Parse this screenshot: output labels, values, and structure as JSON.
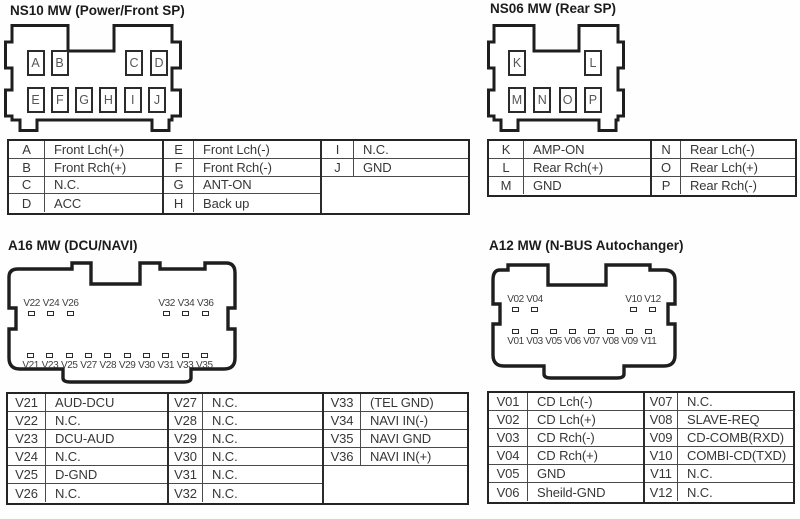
{
  "colors": {
    "ink": "#1e1e1e",
    "table_line": "#4a4a4a",
    "text": "#373737",
    "pin_text": "#555555",
    "background": "#ffffff"
  },
  "ns10": {
    "title": "NS10 MW (Power/Front SP)",
    "connector": {
      "top_left_pins": [
        "A",
        "B"
      ],
      "top_right_pins": [
        "C",
        "D"
      ],
      "bottom_pins": [
        "E",
        "F",
        "G",
        "H",
        "I",
        "J"
      ]
    },
    "table": {
      "group1": [
        {
          "p": "A",
          "d": "Front Lch(+)"
        },
        {
          "p": "B",
          "d": "Front Rch(+)"
        },
        {
          "p": "C",
          "d": "N.C."
        },
        {
          "p": "D",
          "d": "ACC"
        }
      ],
      "group2": [
        {
          "p": "E",
          "d": "Front Lch(-)"
        },
        {
          "p": "F",
          "d": "Front Rch(-)"
        },
        {
          "p": "G",
          "d": "ANT-ON"
        },
        {
          "p": "H",
          "d": "Back up"
        }
      ],
      "group3": [
        {
          "p": "I",
          "d": "N.C."
        },
        {
          "p": "J",
          "d": "GND"
        }
      ]
    }
  },
  "ns06": {
    "title": "NS06 MW (Rear SP)",
    "connector": {
      "top_left_pins": [
        "K"
      ],
      "top_right_pins": [
        "L"
      ],
      "bottom_pins": [
        "M",
        "N",
        "O",
        "P"
      ]
    },
    "table": {
      "group1": [
        {
          "p": "K",
          "d": "AMP-ON"
        },
        {
          "p": "L",
          "d": "Rear Rch(+)"
        },
        {
          "p": "M",
          "d": "GND"
        }
      ],
      "group2": [
        {
          "p": "N",
          "d": "Rear Lch(-)"
        },
        {
          "p": "O",
          "d": "Rear Lch(+)"
        },
        {
          "p": "P",
          "d": "Rear Rch(-)"
        }
      ]
    }
  },
  "a16": {
    "title": "A16 MW (DCU/NAVI)",
    "connector": {
      "top_left_pins": [
        "V22",
        "V24",
        "V26"
      ],
      "top_right_pins": [
        "V32",
        "V34",
        "V36"
      ],
      "bottom_pins": [
        "V21",
        "V23",
        "V25",
        "V27",
        "V28",
        "V29",
        "V30",
        "V31",
        "V33",
        "V35"
      ]
    },
    "table": {
      "group1": [
        {
          "p": "V21",
          "d": "AUD-DCU"
        },
        {
          "p": "V22",
          "d": "N.C."
        },
        {
          "p": "V23",
          "d": "DCU-AUD"
        },
        {
          "p": "V24",
          "d": "N.C."
        },
        {
          "p": "V25",
          "d": "D-GND"
        },
        {
          "p": "V26",
          "d": "N.C."
        }
      ],
      "group2": [
        {
          "p": "V27",
          "d": "N.C."
        },
        {
          "p": "V28",
          "d": "N.C."
        },
        {
          "p": "V29",
          "d": "N.C."
        },
        {
          "p": "V30",
          "d": "N.C."
        },
        {
          "p": "V31",
          "d": "N.C."
        },
        {
          "p": "V32",
          "d": "N.C."
        }
      ],
      "group3": [
        {
          "p": "V33",
          "d": "(TEL GND)"
        },
        {
          "p": "V34",
          "d": "NAVI IN(-)"
        },
        {
          "p": "V35",
          "d": "NAVI GND"
        },
        {
          "p": "V36",
          "d": "NAVI IN(+)"
        }
      ]
    }
  },
  "a12": {
    "title": "A12 MW (N-BUS Autochanger)",
    "connector": {
      "top_left_pins": [
        "V02",
        "V04"
      ],
      "top_right_pins": [
        "V10",
        "V12"
      ],
      "bottom_pins": [
        "V01",
        "V03",
        "V05",
        "V06",
        "V07",
        "V08",
        "V09",
        "V11"
      ]
    },
    "table": {
      "group1": [
        {
          "p": "V01",
          "d": "CD Lch(-)"
        },
        {
          "p": "V02",
          "d": "CD Lch(+)"
        },
        {
          "p": "V03",
          "d": "CD Rch(-)"
        },
        {
          "p": "V04",
          "d": "CD Rch(+)"
        },
        {
          "p": "V05",
          "d": "GND"
        },
        {
          "p": "V06",
          "d": "Sheild-GND"
        }
      ],
      "group2": [
        {
          "p": "V07",
          "d": "N.C."
        },
        {
          "p": "V08",
          "d": "SLAVE-REQ"
        },
        {
          "p": "V09",
          "d": "CD-COMB(RXD)"
        },
        {
          "p": "V10",
          "d": "COMBI-CD(TXD)"
        },
        {
          "p": "V11",
          "d": "N.C."
        },
        {
          "p": "V12",
          "d": "N.C."
        }
      ]
    }
  }
}
